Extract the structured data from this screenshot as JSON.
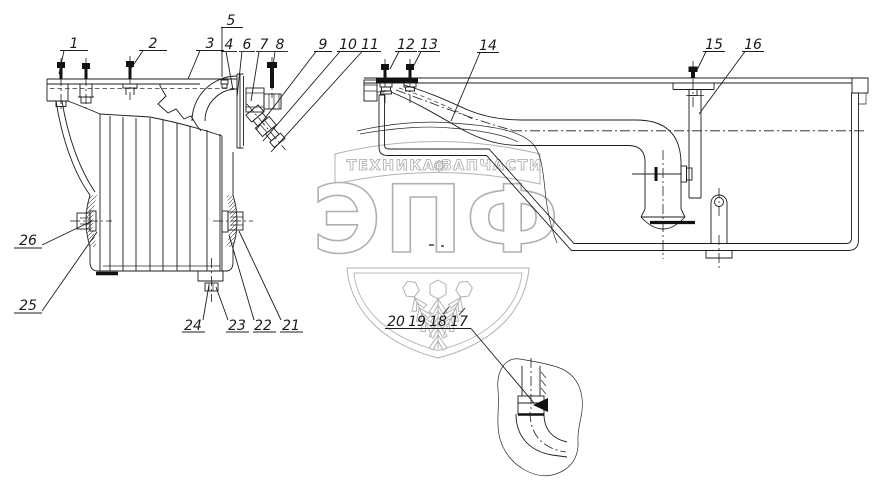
{
  "watermark": {
    "banner_word_left": "ТЕХНИКА",
    "banner_gear": "⚙",
    "banner_word_right": "ЗАПЧАСТИ",
    "logo": "ЭПФ"
  },
  "callouts": {
    "c1": "1",
    "c2": "2",
    "c3": "3",
    "c4": "4",
    "c5": "5",
    "c6": "6",
    "c7": "7",
    "c8": "8",
    "c9": "9",
    "c10": "10",
    "c11": "11",
    "c12": "12",
    "c13": "13",
    "c14": "14",
    "c15": "15",
    "c16": "16",
    "c17": "17",
    "c18": "18",
    "c19": "19",
    "c20": "20",
    "c21": "21",
    "c22": "22",
    "c23": "23",
    "c24": "24",
    "c25": "25",
    "c26": "26"
  }
}
